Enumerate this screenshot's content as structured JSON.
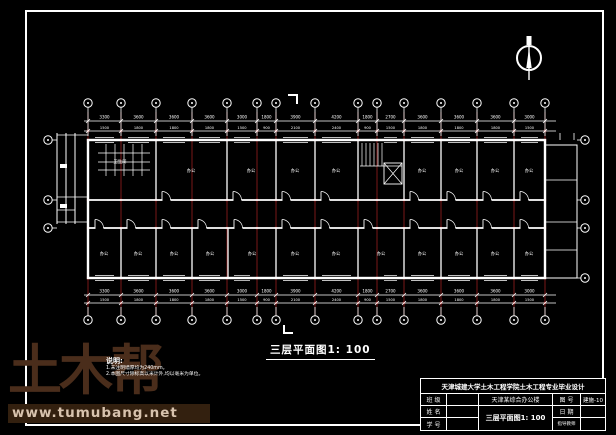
{
  "plan_title": {
    "text": "三层平面图1: 100"
  },
  "notes": {
    "heading": "说明:",
    "line1": "1.未注明墙厚均为240mm。",
    "line2": "2.本图尺寸除标高以米计外,均以毫米为单位。"
  },
  "watermark": {
    "brand": "土木帮",
    "url": "www.tumubang.net",
    "brand_color": "#4a2d1b",
    "url_color": "#d8c3ae",
    "bar_color": "#33200f"
  },
  "titleblock": {
    "school": "天津城建大学土木工程学院土木工程专业毕业设计",
    "left": {
      "r2": "班 级",
      "r3": "姓 名",
      "r4": "学 号"
    },
    "project": "天津某综合办公楼",
    "drawing_title": "三层平面图1: 100",
    "right": {
      "r2_label": "图 号",
      "r2_value": "建施-10",
      "r3_label": "日 期",
      "r3_value": "",
      "r4_label": "指导教师",
      "r4_value": ""
    }
  },
  "plan": {
    "colors": {
      "line": "#ffffff",
      "grid": "#7a1818",
      "dot": "#a02020"
    },
    "grid_x": [
      88,
      121,
      156,
      192,
      227,
      257,
      276,
      315,
      358,
      377,
      404,
      441,
      477,
      514,
      545
    ],
    "bubble_top_y": 103,
    "bubble_bottom_y": 320,
    "left_bubbles": {
      "x": 48,
      "ys": [
        140,
        200,
        228
      ]
    },
    "right_bubbles": {
      "x": 585,
      "ys": [
        140,
        200,
        228,
        278
      ]
    },
    "wall_ys": {
      "top": 140,
      "corridor_top": 200,
      "corridor_bottom": 228,
      "bottom": 278
    },
    "building": {
      "x1": 88,
      "x2": 545
    },
    "dims_row1": [
      "3300",
      "3600",
      "3600",
      "3600",
      "3000",
      "1800",
      "3900",
      "4200",
      "1800",
      "2700",
      "3600",
      "3600",
      "3600",
      "3000"
    ],
    "dims_row2": [
      "1500",
      "1800",
      "1800",
      "1800",
      "1500",
      "900",
      "2100",
      "2400",
      "900",
      "1500",
      "1800",
      "1800",
      "1800",
      "1500"
    ],
    "top_partitions": [
      156,
      227,
      276,
      315,
      358,
      404,
      441,
      477,
      514
    ],
    "bottom_partitions": [
      121,
      156,
      192,
      228,
      276,
      315,
      358,
      404,
      441,
      477,
      514
    ],
    "doors_top": [
      162,
      233,
      282,
      321,
      410,
      447,
      483,
      520
    ],
    "doors_bottom": [
      95,
      127,
      162,
      198,
      234,
      282,
      321,
      364,
      410,
      447,
      483,
      520
    ],
    "rooms": [
      {
        "x": 120,
        "y": 163,
        "label": "卫生间"
      },
      {
        "x": 191,
        "y": 172,
        "label": "办公"
      },
      {
        "x": 251,
        "y": 172,
        "label": "办公"
      },
      {
        "x": 295,
        "y": 172,
        "label": "办公"
      },
      {
        "x": 336,
        "y": 172,
        "label": "办公"
      },
      {
        "x": 422,
        "y": 172,
        "label": "办公"
      },
      {
        "x": 459,
        "y": 172,
        "label": "办公"
      },
      {
        "x": 495,
        "y": 172,
        "label": "办公"
      },
      {
        "x": 529,
        "y": 172,
        "label": "办公"
      },
      {
        "x": 104,
        "y": 255,
        "label": "办公"
      },
      {
        "x": 138,
        "y": 255,
        "label": "办公"
      },
      {
        "x": 174,
        "y": 255,
        "label": "办公"
      },
      {
        "x": 210,
        "y": 255,
        "label": "办公"
      },
      {
        "x": 252,
        "y": 255,
        "label": "办公"
      },
      {
        "x": 295,
        "y": 255,
        "label": "办公"
      },
      {
        "x": 336,
        "y": 255,
        "label": "办公"
      },
      {
        "x": 381,
        "y": 255,
        "label": "办公"
      },
      {
        "x": 422,
        "y": 255,
        "label": "办公"
      },
      {
        "x": 459,
        "y": 255,
        "label": "办公"
      },
      {
        "x": 495,
        "y": 255,
        "label": "办公"
      },
      {
        "x": 529,
        "y": 255,
        "label": "办公"
      }
    ],
    "stair": {
      "x1": 360,
      "x2": 402,
      "y1": 143,
      "y2": 186
    },
    "toilet": {
      "x1": 96,
      "x2": 152,
      "y1": 142,
      "y2": 184
    },
    "left_annex": {
      "xs": [
        57,
        66,
        75
      ],
      "y1": 133,
      "y2": 224
    },
    "right_annex": {
      "x1": 545,
      "x2": 577,
      "y1": 145,
      "y2": 278
    },
    "north": {
      "cx": 529,
      "cy": 58,
      "r": 12
    },
    "section_marks": {
      "top": [
        288,
        95
      ],
      "bottom": [
        284,
        325
      ]
    }
  }
}
